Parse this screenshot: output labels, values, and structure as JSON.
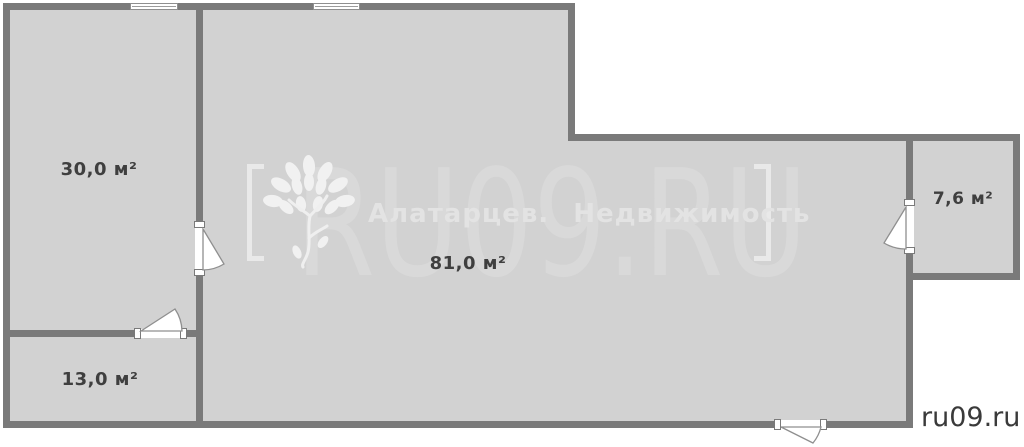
{
  "palette": {
    "background": "#ffffff",
    "floor_fill": "#d2d2d2",
    "wall_color": "#7a7a7a",
    "room_label_color": "#3f3f3f",
    "watermark_big_color": "#d9d9d9",
    "watermark_subtitle_color": "#e3e3e3",
    "site_label_color": "#3a3a3a"
  },
  "rooms": [
    {
      "name": "room-left-top",
      "label": "30,0 м²",
      "area_m2": 30.0
    },
    {
      "name": "room-left-bottom",
      "label": "13,0 м²",
      "area_m2": 13.0
    },
    {
      "name": "room-main",
      "label": "81,0 м²",
      "area_m2": 81.0
    },
    {
      "name": "room-right",
      "label": "7,6 м²",
      "area_m2": 7.6
    }
  ],
  "area_unit": "м²",
  "watermark": {
    "brand": "RU09.RU",
    "agency": "Алатарцев. Недвижимость",
    "logo": "tree-logo"
  },
  "footer": {
    "site_label": "ru09.ru"
  }
}
